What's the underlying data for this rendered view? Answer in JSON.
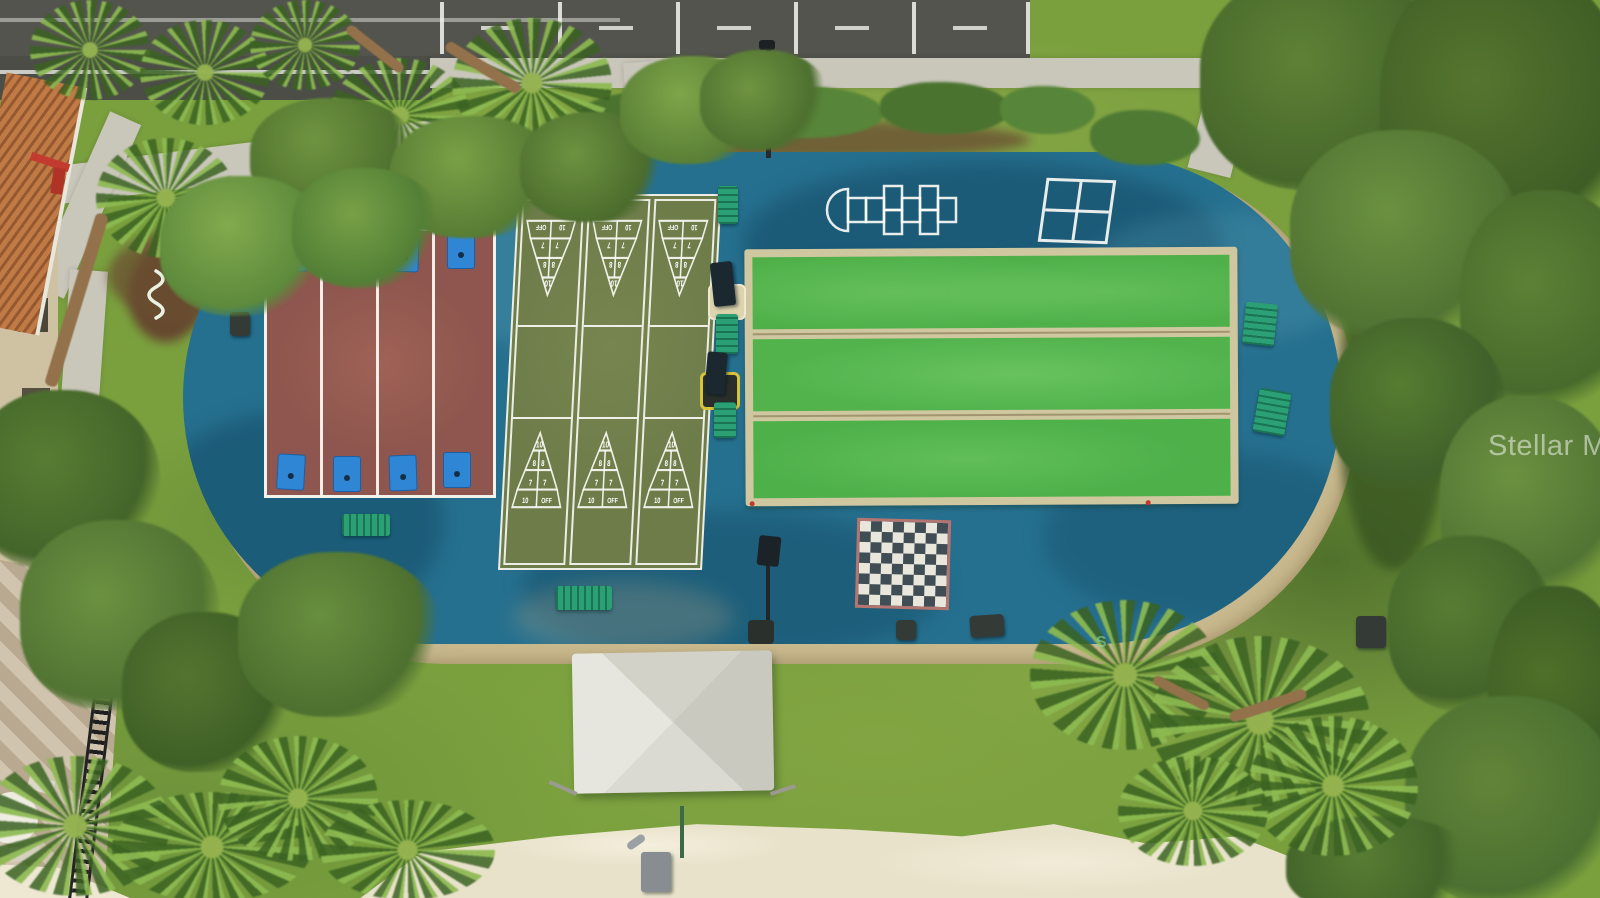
{
  "meta": {
    "description": "Aerial drone view of a community games lawn with shuffleboard, bocce, cornhole, checkerboard, hopscotch and four-square courts"
  },
  "watermark": {
    "text": "Stellar MLS",
    "logo": "S"
  },
  "shuffleboard": {
    "courts": 3,
    "scoring": {
      "apex": "10",
      "second": "8",
      "third": "7",
      "penalty_left": "10",
      "penalty_right": "OFF"
    }
  },
  "counts": {
    "cornhole_lanes": 4,
    "cornhole_boards": 8,
    "bocce_lanes": 3,
    "checkerboard": "8x8",
    "benches": 7
  },
  "colors": {
    "court_surface_blue": "#26708f",
    "cornhole_court_maroon": "#8e564e",
    "shuffleboard_green": "#6d7c49",
    "bocce_turf_green": "#4fb04a",
    "bocce_frame_tan": "#cfc7a0",
    "bench_teal": "#2aa074",
    "cornhole_board_blue": "#2f86d4",
    "checker_dark": "#414d54",
    "checker_light": "#e9e6dc",
    "checker_border": "#b3756f",
    "shade_sail": "#d8d8d0",
    "gravel": "#c9b98e"
  }
}
